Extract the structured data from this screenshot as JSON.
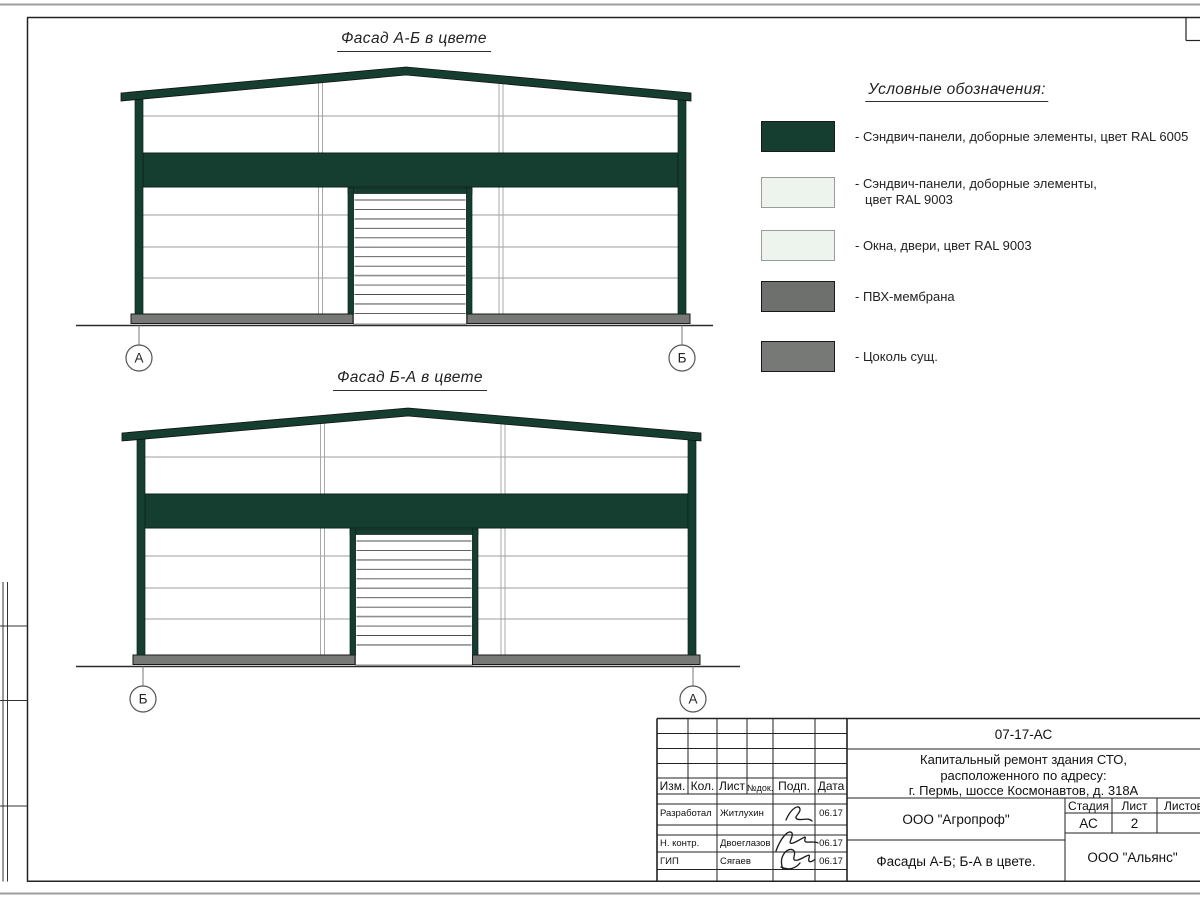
{
  "sheet": {
    "facade_titles": [
      "Фасад А-Б в цвете",
      "Фасад Б-А в цвете"
    ],
    "facade_markers": [
      [
        "А",
        "Б"
      ],
      [
        "Б",
        "А"
      ]
    ]
  },
  "legend": {
    "heading": "Условные обозначения:",
    "items": [
      {
        "color": "#153E30",
        "border": "#1a1a1a",
        "label": "- Сэндвич-панели, доборные элементы,  цвет RAL 6005",
        "label2": ""
      },
      {
        "color": "#EDF4ED",
        "border": "#9a9a9a",
        "label": "- Сэндвич-панели, доборные элементы,",
        "label2": "цвет RAL 9003"
      },
      {
        "color": "#EDF4ED",
        "border": "#9a9a9a",
        "label": "- Окна, двери, цвет RAL 9003",
        "label2": ""
      },
      {
        "color": "#6E706E",
        "border": "#1a1a1a",
        "label": "- ПВХ-мембрана",
        "label2": ""
      },
      {
        "color": "#777977",
        "border": "#1a1a1a",
        "label": "- Цоколь сущ.",
        "label2": ""
      }
    ]
  },
  "titleblock": {
    "doc_code": "07-17-АС",
    "project_line1": "Капитальный ремонт здания СТО,",
    "project_line2": "расположенного по адресу:",
    "project_line3": "г. Пермь, шоссе Космонавтов, д. 318А",
    "org": "ООО \"Агропроф\"",
    "sheet_title": "Фасады А-Б; Б-А в цвете.",
    "contractor": "ООО \"Альянс\"",
    "stage_label": "Стадия",
    "sheet_label": "Лист",
    "sheets_label": "Листов",
    "stage_value": "АС",
    "sheet_value": "2",
    "sheets_value": "",
    "col_izm": "Изм.",
    "col_kol": "Кол.",
    "col_list": "Лист",
    "col_ndok": "№док.",
    "col_podp": "Подп.",
    "col_data": "Дата",
    "rows": [
      {
        "role": "Разработал",
        "name": "Житлухин",
        "date": "06.17"
      },
      {
        "role": "Н. контр.",
        "name": "Двоеглазов",
        "date": "06.17"
      },
      {
        "role": "ГИП",
        "name": "Сягаев",
        "date": "06.17"
      }
    ]
  },
  "colors": {
    "ral6005": "#153E30",
    "ral9003": "#EDF4ED",
    "pvc_membrane": "#6E706E",
    "plinth": "#777977"
  }
}
